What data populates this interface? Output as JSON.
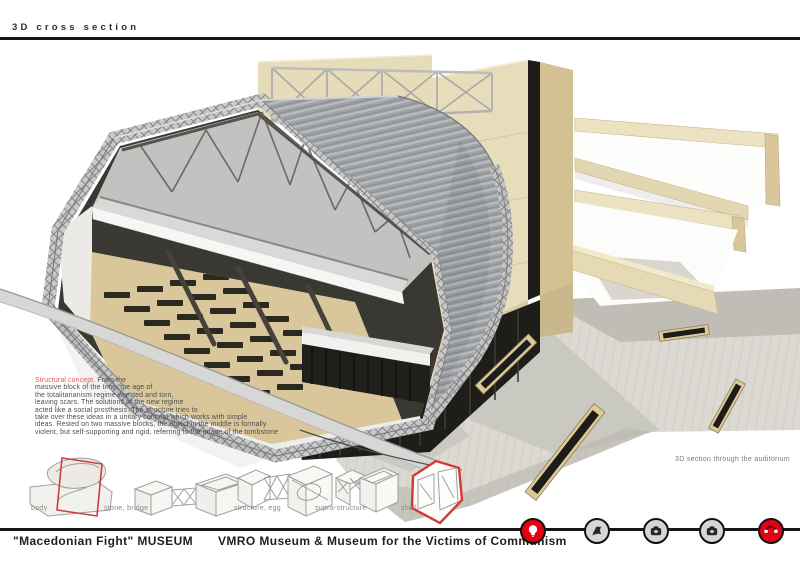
{
  "header": {
    "title": "3D cross section"
  },
  "annotation": {
    "heading": "Structural concept.",
    "lines": [
      "From the",
      "massive block of the time, the age of",
      "the totalitarianism regime wrested and torn,",
      "leaving scars. The solutions of the new regime",
      "acted like a social prosthesis. The structure tries to",
      "take over these ideas in a unitary concept which works with simple",
      "ideas. Rested on two massive blocks, the object in the middle is formally",
      "violent, but self-supporting and rigid, referring to the image of the tombstone"
    ]
  },
  "caption": {
    "text": "3D section through the auditorium"
  },
  "diagrams": {
    "labels": [
      "body",
      "stone, bridge",
      "structure, egg",
      "supra-structure",
      "shell"
    ]
  },
  "footer": {
    "left_title": "\"Macedonian Fight\" MUSEUM",
    "center_title": "VMRO Museum & Museum for the Victims of Communism",
    "icons": [
      {
        "name": "lightbulb",
        "style": "red"
      },
      {
        "name": "flag",
        "style": "gray"
      },
      {
        "name": "camera",
        "style": "gray"
      },
      {
        "name": "camera",
        "style": "gray"
      },
      {
        "name": "rotate",
        "style": "red"
      }
    ]
  },
  "colors": {
    "accent_red": "#e60012",
    "annotation_red": "#e05a50",
    "diagram_red": "#cf3b35",
    "wood_light": "#e8ddbb",
    "wood_dark": "#d3c193",
    "shell_gray": "#9fa3a6",
    "seat_dark": "#2b2820",
    "floor_tan": "#d9c69a",
    "text_dark": "#1f1f1f"
  }
}
